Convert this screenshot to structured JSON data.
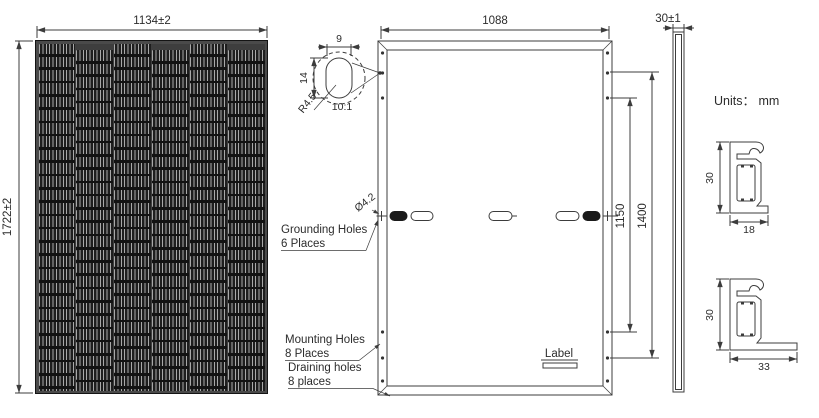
{
  "figure": {
    "title_hint": "Solar module mechanical drawing",
    "units_label": "Units： mm",
    "front_view": {
      "width_dim": "1134±2",
      "height_dim": "1722±2",
      "columns": 6,
      "rows": 27
    },
    "back_view": {
      "width_dim": "1088",
      "mount_spacing_inner": "1150",
      "mount_spacing_outer": "1400",
      "hole_note": "Ø4.2",
      "grounding_note": [
        "Grounding Holes",
        "6 Places"
      ],
      "mounting_note": [
        "Mounting Holes",
        "8 Places"
      ],
      "draining_note": [
        "Draining holes",
        "8 places"
      ],
      "label_text": "Label"
    },
    "detail_view": {
      "width_dim": "9",
      "height_dim": "14",
      "radius_dim": "R4.5",
      "scale": "10:1"
    },
    "side_view": {
      "thickness_dim": "30±1"
    },
    "profiles": {
      "top": {
        "height_dim": "30",
        "width_dim": "18"
      },
      "bottom": {
        "height_dim": "30",
        "width_dim": "33"
      }
    }
  }
}
